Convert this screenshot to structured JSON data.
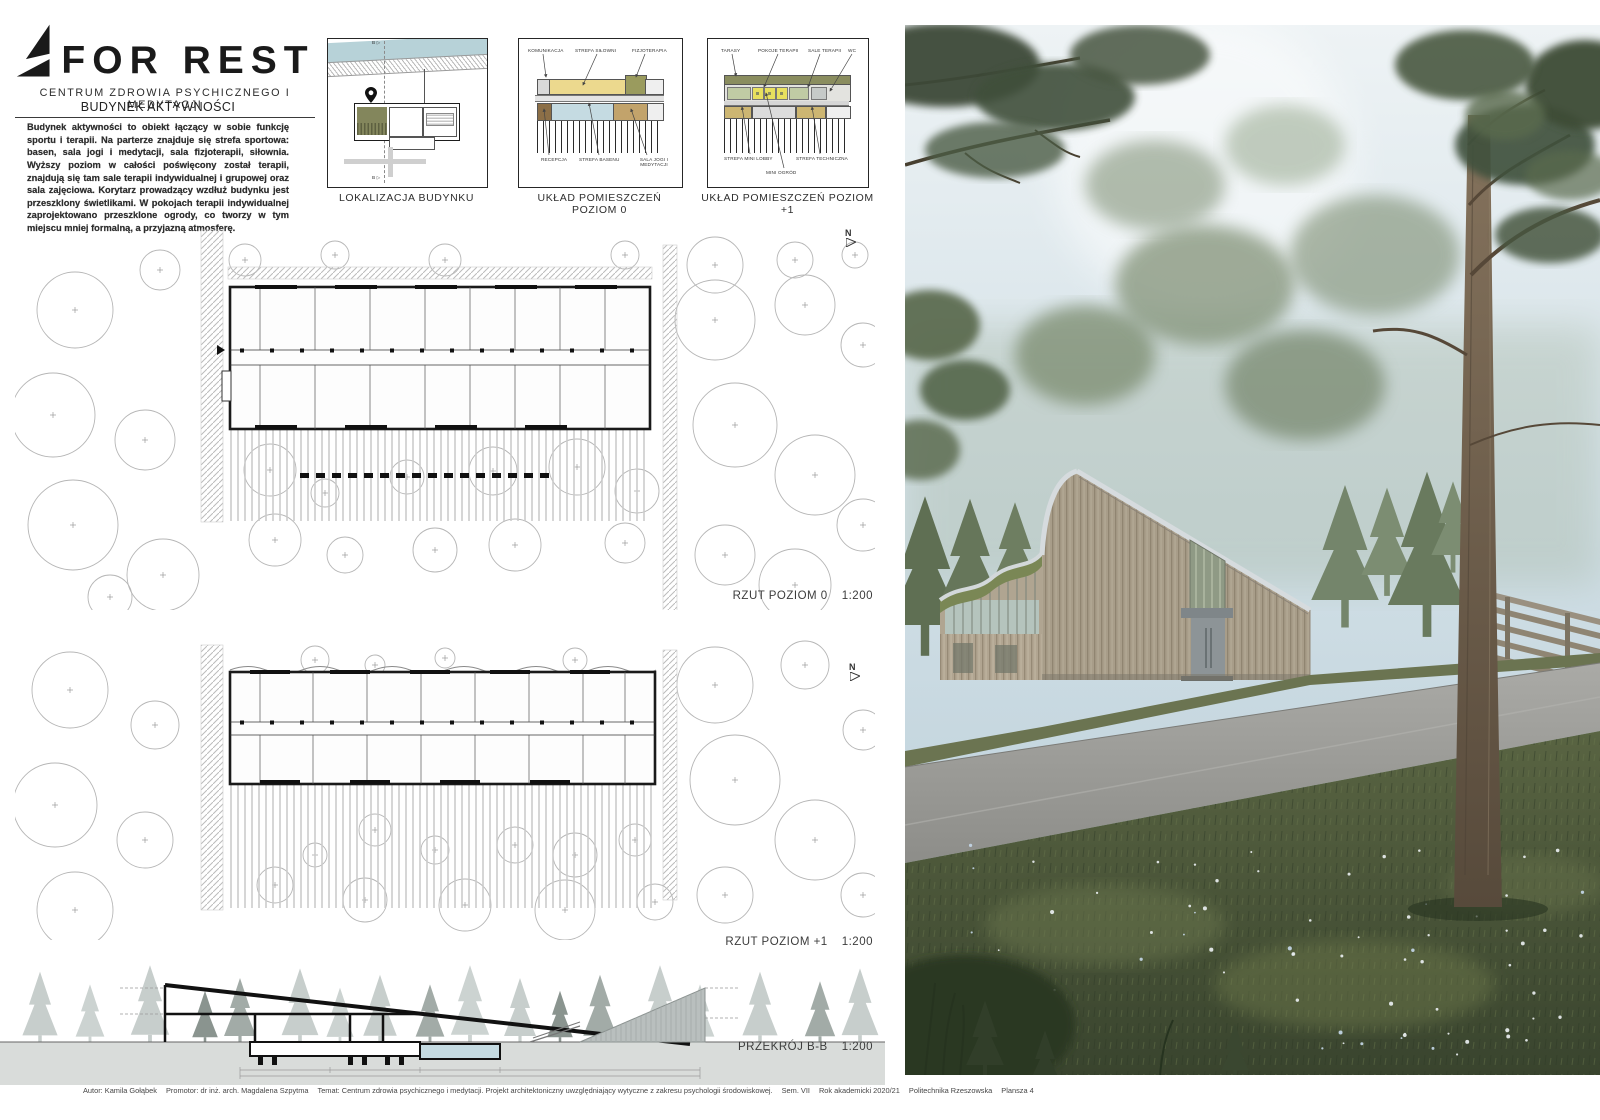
{
  "logo": {
    "title": "FOR REST",
    "subtitle": "CENTRUM ZDROWIA PSYCHICZNEGO I MEDYTACJI"
  },
  "intro": {
    "title": "BUDYNEK AKTYWNOŚCI",
    "body": "Budynek aktywności to obiekt łączący w sobie funkcję sportu i terapii. Na parterze znajduje się strefa sportowa: basen, sala jogi i medytacji, sala fizjoterapii, siłownia. Wyższy poziom w całości poświęcony został terapii, znajdują się tam sale terapii indywidualnej i grupowej oraz sala zajęciowa. Korytarz prowadzący wzdłuż budynku jest przeszklony świetlikami. W pokojach terapii indywidualnej zaprojektowano przeszklone ogrody, co tworzy w tym miejscu mniej formalną, a przyjazną atmosferę."
  },
  "diagrams": {
    "location": {
      "caption": "LOKALIZACJA BUDYNKU",
      "section_marker": "B ▷"
    },
    "level0": {
      "caption": "UKŁAD POMIESZCZEŃ POZIOM 0",
      "labels_top": [
        "KOMUNIKACJA",
        "STREFA SIŁOWNI",
        "FIZJOTERAPIA"
      ],
      "labels_bottom": [
        "RECEPCJA",
        "STREFA BASENU",
        "SALA JOGI I MEDYTACJI"
      ]
    },
    "level1": {
      "caption": "UKŁAD POMIESZCZEŃ POZIOM +1",
      "labels_top": [
        "TARASY",
        "POKOJE TERAPII",
        "SALE TERAPII",
        "WC"
      ],
      "labels_bottom": [
        "STREFA MINI LOBBY",
        "STREFA TECHNICZNA",
        "MINI OGRÓD"
      ]
    }
  },
  "plans": {
    "level0_label": "RZUT POZIOM 0",
    "level0_scale": "1:200",
    "level1_label": "RZUT POZIOM +1",
    "level1_scale": "1:200",
    "north": "N"
  },
  "section": {
    "label": "PRZEKRÓJ B-B",
    "scale": "1:200"
  },
  "footer": {
    "author": "Autor: Kamila Gołąbek",
    "promotor": "Promotor: dr inż. arch. Magdalena Szpytma",
    "temat": "Temat: Centrum zdrowia psychicznego i medytacji. Projekt architektoniczny uwzględniający wytyczne z zakresu psychologii środowiskowej.",
    "sem": "Sem. VII",
    "rok": "Rok akademicki 2020/21",
    "uczelnia": "Politechnika Rzeszowska",
    "plansza": "Plansza 4"
  },
  "colors": {
    "water": "#b7d2d8",
    "olive": "#83865c",
    "yellow": "#ecd98e",
    "olive_dark": "#9a9b5e",
    "pool_blue": "#c5dbe2",
    "tan": "#c2a36b",
    "brown": "#8c6f47",
    "green_light": "#c0cba4",
    "yellow_bright": "#e8e05e",
    "terrace_olive": "#8a8d5f"
  }
}
